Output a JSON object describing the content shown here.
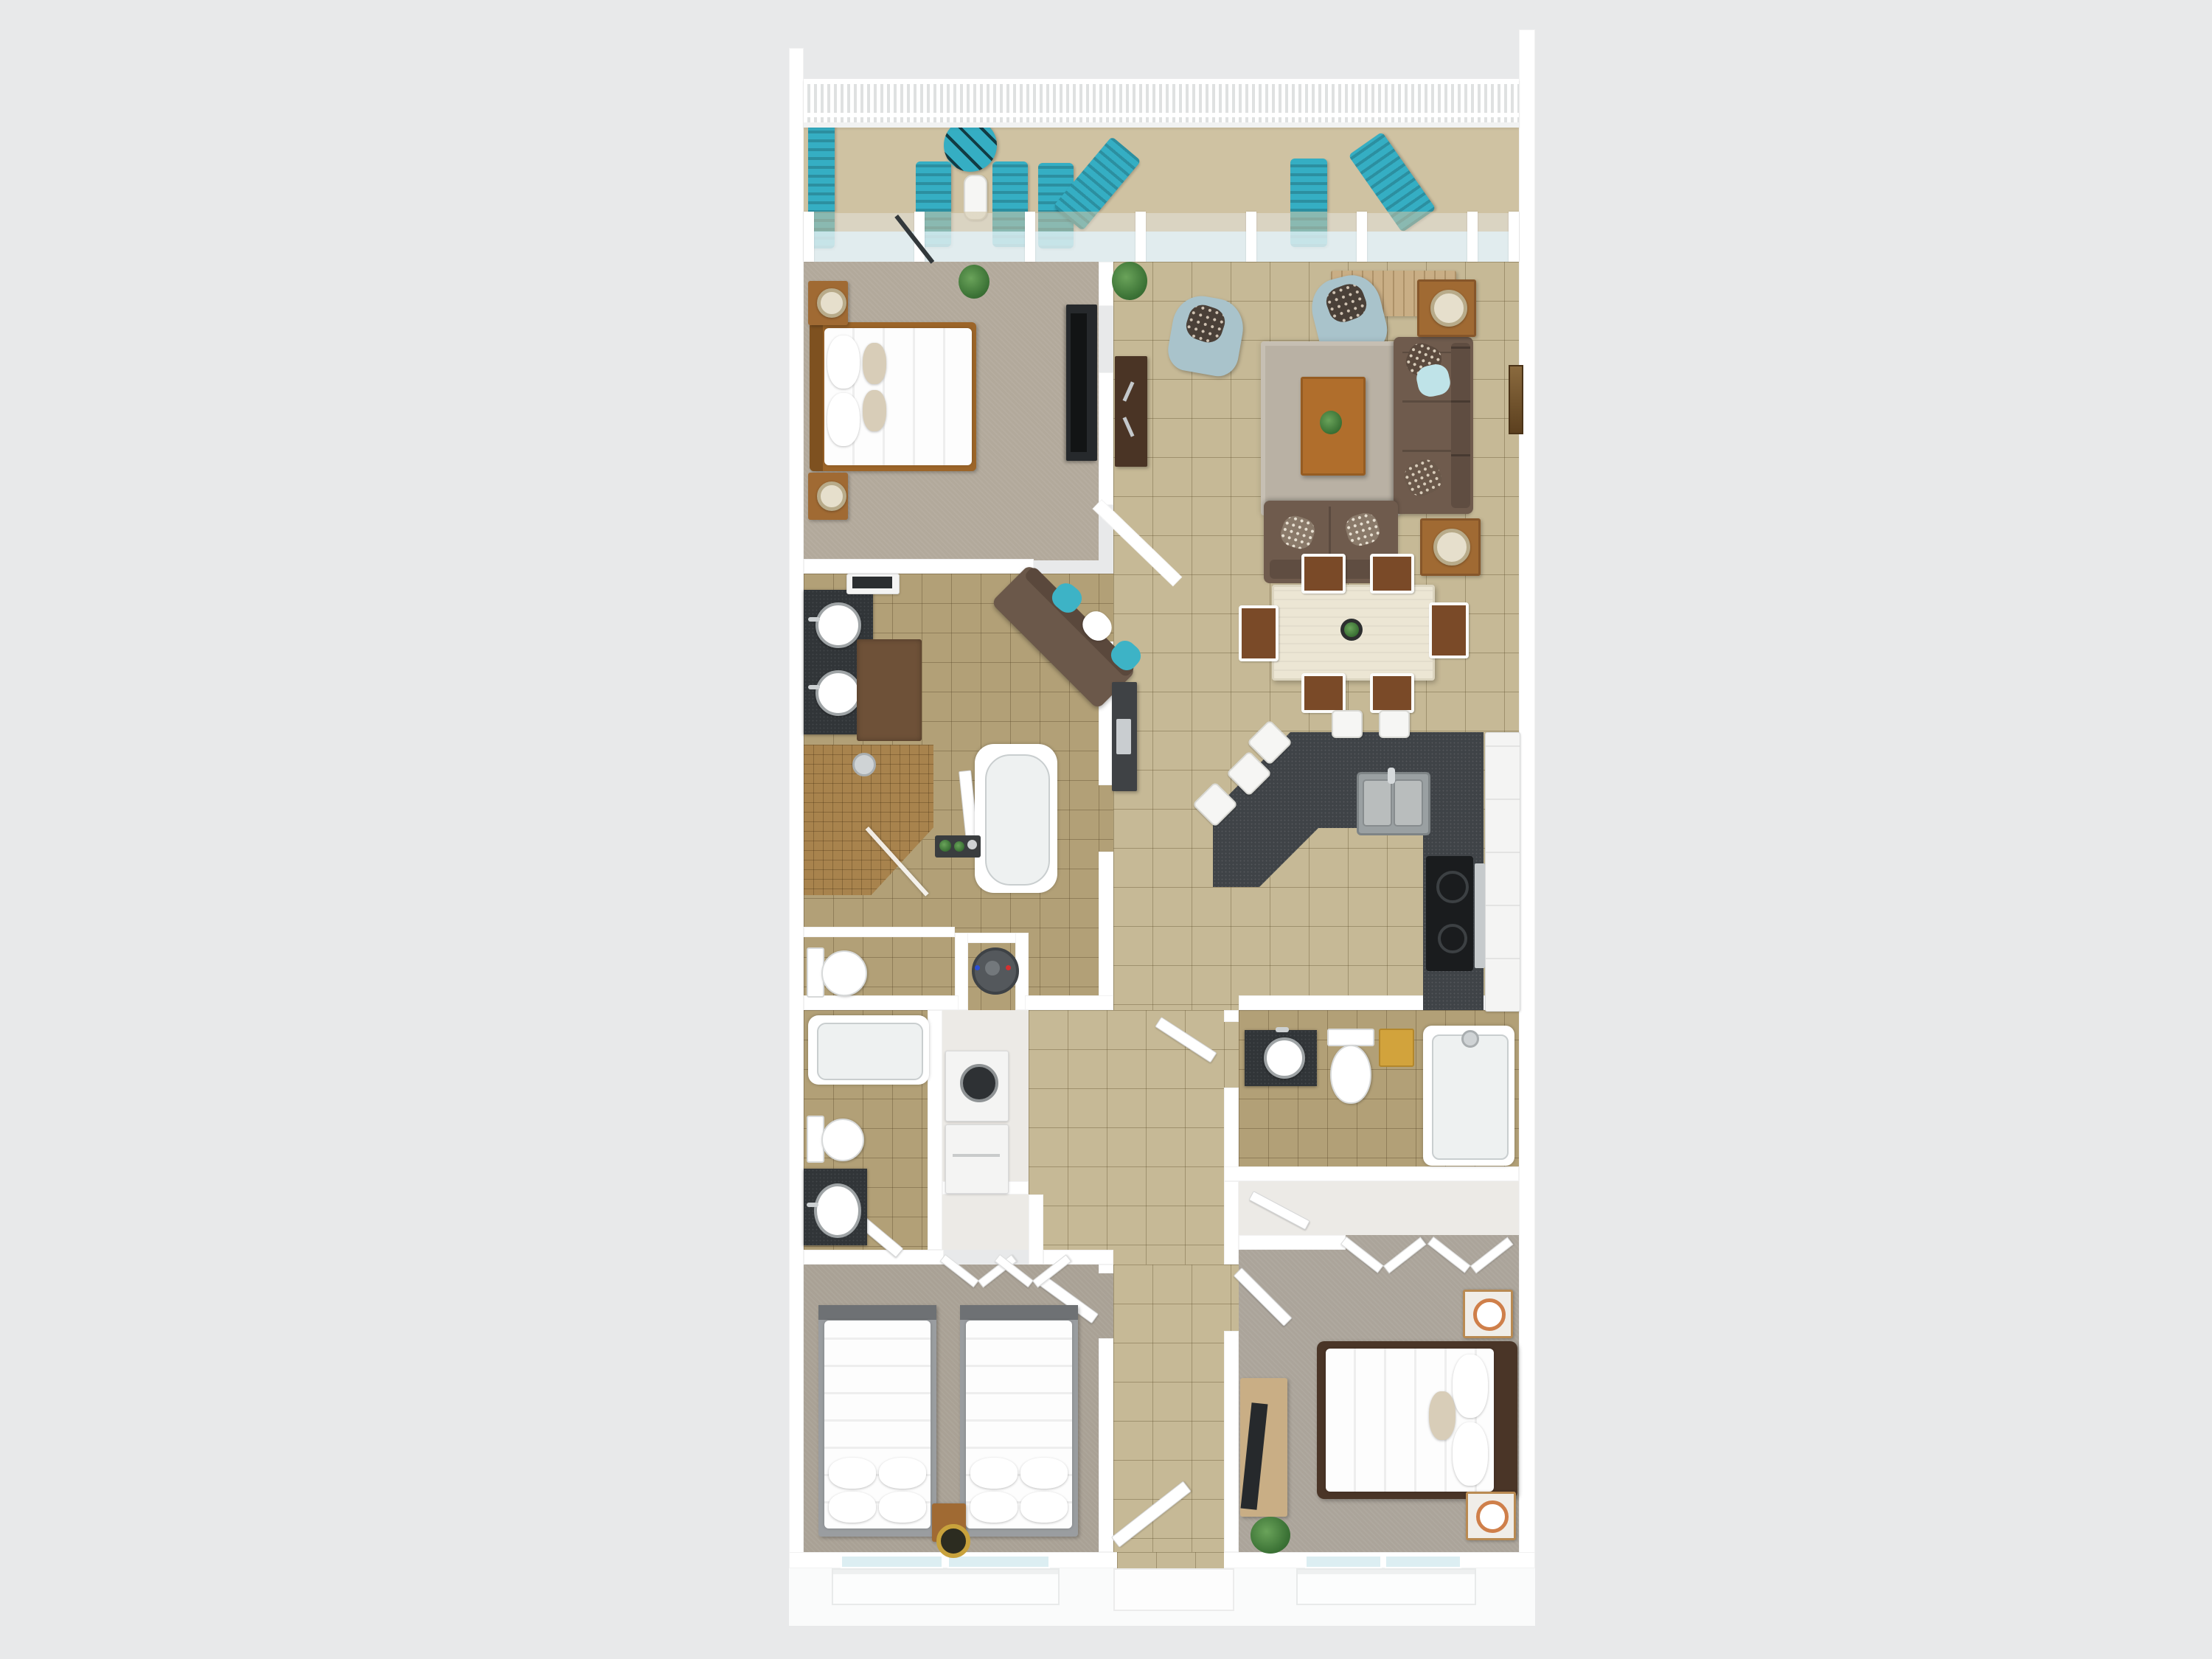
{
  "meta": {
    "kind": "3d-floor-plan-rendering",
    "view": "top-down dollhouse view",
    "visible_text": "none"
  },
  "colors": {
    "bg": "#e8e9ea",
    "ground": "#fafbfb",
    "wall": "#ffffff",
    "balconyFloor": "#cfc2a2",
    "tileFloor": "#c6b996",
    "bathFloor": "#b2a077",
    "closetFloor": "#eceae6",
    "carpetMaster": "#b2a99b",
    "carpetBed2": "#a9a195",
    "carpetBed3": "#aba49a",
    "teal": "#35aec3",
    "counter": "#3f4347",
    "cooktop": "#1a1c1e",
    "steel": "#c6cacc",
    "wood": "#9c6529",
    "woodMid": "#a06a33",
    "woodLight": "#c9ae85",
    "woodDark": "#4a3527",
    "espresso": "#4a3425",
    "sofaBrown": "#6f5b4d",
    "loveseatBrown": "#6b584a",
    "armchairBlue": "#a9c3cb",
    "rug": "#b9b1a4",
    "diningTable": "#ece6d4",
    "chairSeatBrown": "#7a4a28",
    "vanityDark": "#313538",
    "tvDark": "#26292c",
    "showerTile": "#a8834d",
    "yellow": "#d2a33c",
    "gold": "#c8a23c",
    "glass": "#dceef2",
    "mattress": "#fdfdfd",
    "pillowTan": "#d8cdb8",
    "brownRug": "#6e5138",
    "appliance": "#f4f4f3",
    "heater": "#54585c",
    "plantGreen": "#4e8a46"
  },
  "rooms": [
    {
      "id": "balcony",
      "floor": "tan decking",
      "items": [
        "teal-bench",
        "teal-bistro-table",
        "white-bar-stools-2",
        "teal-deck-chairs-4",
        "teal-rocking-chair",
        "white-picket-railing",
        "sliding-glass-wall"
      ]
    },
    {
      "id": "master-bedroom",
      "floor": "carpet",
      "items": [
        "king-bed-wood-frame",
        "nightstand-2",
        "table-lamps",
        "tv-dresser-dark",
        "potted-plant"
      ]
    },
    {
      "id": "living-room",
      "floor": "large tile",
      "items": [
        "brown-sofa",
        "brown-loveseat",
        "blue-armchair-2",
        "shag-rug",
        "wood-coffee-table",
        "end-table-2",
        "lamps",
        "sideboard",
        "wall-art"
      ]
    },
    {
      "id": "dining-area",
      "floor": "large tile",
      "items": [
        "cream-dining-table",
        "dining-chairs-6",
        "centerpiece-plant"
      ]
    },
    {
      "id": "kitchen",
      "floor": "large tile",
      "items": [
        "charcoal-g-shaped-counter",
        "double-sink",
        "cooktop",
        "white-bar-stools-5",
        "white-cabinets"
      ]
    },
    {
      "id": "master-bathroom",
      "floor": "small tile",
      "items": [
        "double-vessel-sink-vanity",
        "walk-in-mosaic-shower",
        "freestanding-tub",
        "toilet",
        "bath-rug",
        "linen-cabinet"
      ]
    },
    {
      "id": "utility",
      "items": [
        "water-heater",
        "stacked-washer-dryer"
      ]
    },
    {
      "id": "bathroom-2",
      "floor": "small tile",
      "items": [
        "tub",
        "toilet",
        "dark-vanity-oval-sink"
      ]
    },
    {
      "id": "bathroom-3",
      "floor": "small tile",
      "items": [
        "dark-vanity-round-sink",
        "toilet",
        "yellow-hamper",
        "tub"
      ]
    },
    {
      "id": "bedroom-2",
      "floor": "carpet",
      "items": [
        "double-bed-2",
        "shared-nightstand",
        "gold-lamp",
        "closet-bifold-doors",
        "window"
      ]
    },
    {
      "id": "bedroom-3",
      "floor": "carpet",
      "items": [
        "queen-bed-dark-frame",
        "nightstand-2",
        "lamps",
        "tv-console",
        "fern-plant",
        "closet-bifold-doors",
        "window"
      ]
    },
    {
      "id": "hallway-foyer",
      "floor": "large tile",
      "items": [
        "angled-nook-loveseat-teal-pillows",
        "espresso-console",
        "dark-buffet-cabinet",
        "entry-door"
      ]
    }
  ]
}
